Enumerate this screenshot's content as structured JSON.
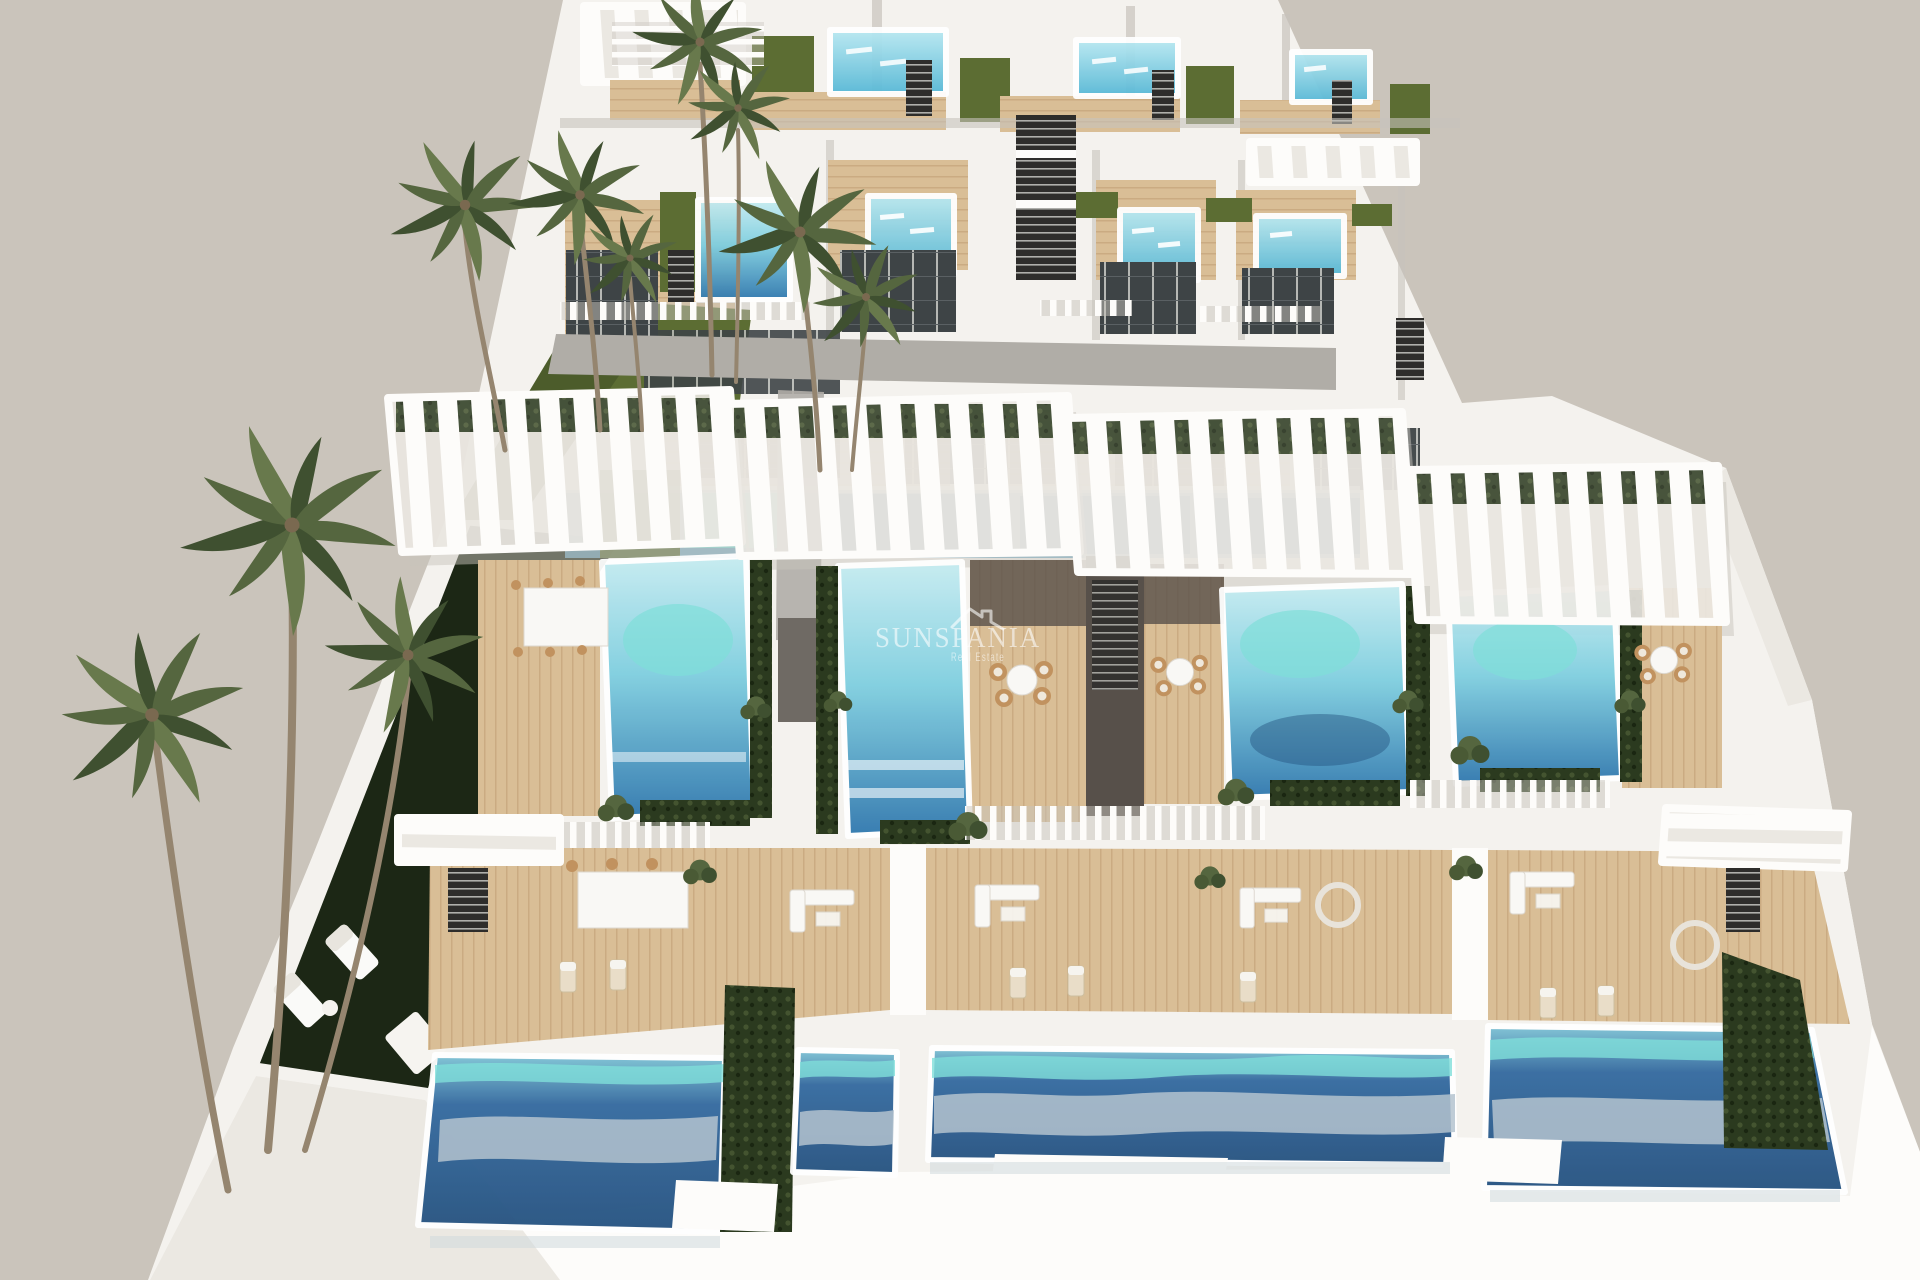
{
  "meta": {
    "type": "3d-architectural-render",
    "description": "Aerial view of a modern white villa development with rooftop and ground-level private pools, timber sun decks, white slatted pergolas, dark garden lawn and palm trees on a plain warm-grey backdrop"
  },
  "watermark": {
    "brand": "SUNSPANIA",
    "tagline": "Real Estate",
    "icon": "house-roof-icon",
    "color": "#ffffff"
  },
  "palette": {
    "background": "#cac4bb",
    "white_bright": "#fdfcfa",
    "white": "#f4f2ee",
    "white_soft": "#ebe8e2",
    "shadow": "#c7c3bc",
    "concrete": "#b0ada7",
    "wood": "#d9be96",
    "wood_line": "#c2a178",
    "wood_dark": "#57504a",
    "lawn": "#5c6d33",
    "lawn_dark": "#1c2715",
    "hedge": "#2b3a1f",
    "hedge_light": "#4a5a35",
    "palm_dark": "#3f5030",
    "palm_mid": "#55663f",
    "palm_light": "#68794c",
    "trunk": "#95856f",
    "glass": "#3e4446",
    "glass_line": "#d5d5d0",
    "stair_dark": "#2e2d2b",
    "pool_ground_top": "#7ec4d6",
    "pool_ground_mid": "#33699f",
    "pool_ground_deep": "#24517f",
    "pool_reflection": "#b4c3cf",
    "pool_roof_light": "#c6ecf1",
    "pool_roof_mid": "#7fcfe0",
    "pool_roof_deep": "#2f77ae",
    "pool_top_light": "#b9e9f2",
    "pool_top_deep": "#56b8d6",
    "pool_turquoise": "#7fded9",
    "watermark": "#ffffff"
  },
  "scene": {
    "rows": [
      {
        "name": "roof-terraces",
        "units": 3,
        "features": "small plunge pools, white railings, green roof strips"
      },
      {
        "name": "upper-villas",
        "units": 4,
        "features": "turquoise rooftop pools with in-pool loungers, timber decks, black switchback stairs, lawn strips"
      },
      {
        "name": "middle-villas",
        "units": 4,
        "features": "white slatted pergolas, long rooftop pools with hedge planters, dining decks with wicker chairs"
      },
      {
        "name": "ground-level",
        "units": 4,
        "features": "timber terraces with white lounge furniture, slatted balconies, large private pools"
      }
    ],
    "palm_trees": {
      "upper_group": 7,
      "left_group": 3
    },
    "lawn": "dark green garden strip lower-left with two white sun loungers"
  }
}
